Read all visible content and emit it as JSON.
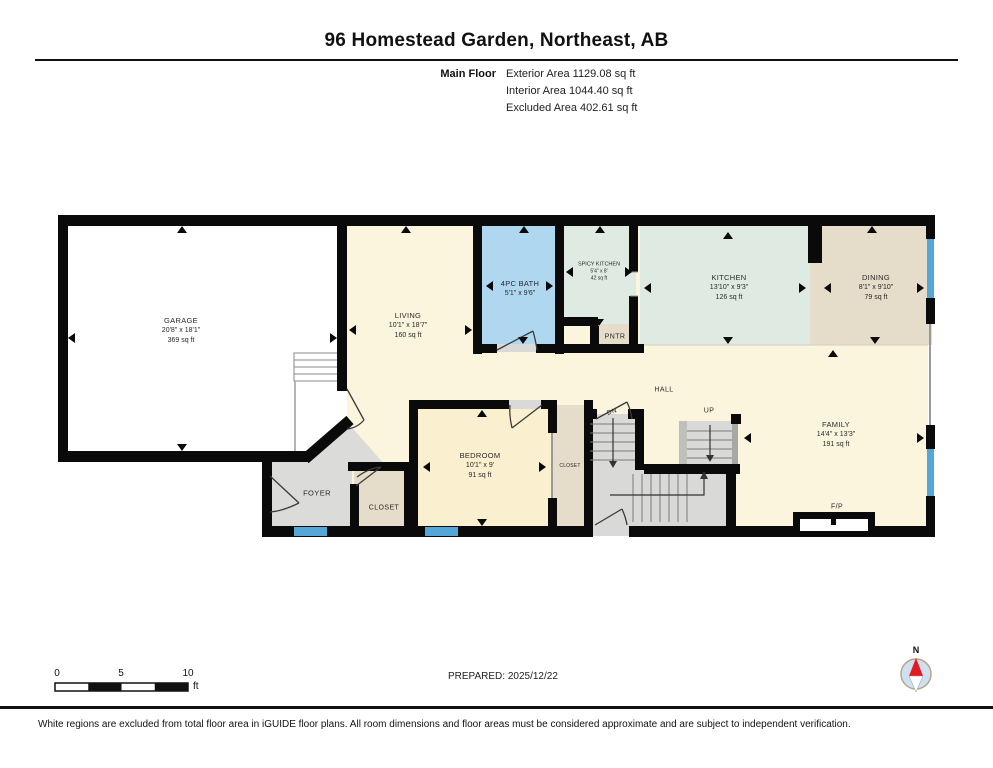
{
  "header": {
    "title": "96 Homestead Garden, Northeast, AB",
    "floor_label": "Main Floor",
    "area_lines": [
      "Exterior Area 1129.08 sq ft",
      "Interior Area 1044.40 sq ft",
      "Excluded Area 402.61 sq ft"
    ]
  },
  "rooms": [
    {
      "name": "GARAGE",
      "dims": "20'8\" x 18'1\"",
      "area": "369 sq ft"
    },
    {
      "name": "LIVING",
      "dims": "10'1\" x 18'7\"",
      "area": "160 sq ft"
    },
    {
      "name": "4PC BATH",
      "dims": "5'1\" x 9'6\"",
      "area": ""
    },
    {
      "name": "SPICY KITCHEN",
      "dims": "5'4\" x 8'",
      "area": "42 sq ft"
    },
    {
      "name": "KITCHEN",
      "dims": "13'10\" x 9'3\"",
      "area": "126 sq ft"
    },
    {
      "name": "DINING",
      "dims": "8'1\" x 9'10\"",
      "area": "79 sq ft"
    },
    {
      "name": "BEDROOM",
      "dims": "10'1\" x 9'",
      "area": "91 sq ft"
    },
    {
      "name": "FAMILY",
      "dims": "14'4\" x 13'3\"",
      "area": "191 sq ft"
    }
  ],
  "labels": {
    "hall": "HALL",
    "dn": "DN",
    "up": "UP",
    "pntr": "PNTR",
    "foyer": "FOYER",
    "closet_entry": "CLOSET",
    "closet_bedroom": "CLOSET",
    "fireplace": "F/P"
  },
  "scale_bar": {
    "tick_0": "0",
    "tick_5": "5",
    "tick_10": "10",
    "unit": "ft"
  },
  "prepared_label": "PREPARED: 2025/12/22",
  "compass": {
    "north_label": "N"
  },
  "footer": {
    "disclaimer": "White regions are excluded from total floor area in iGUIDE floor plans. All room dimensions and floor areas must be considered approximate and are subject to independent verification."
  },
  "colors": {
    "floor_cream": "#FBF5DE",
    "bedroom_cream": "#FAEFCE",
    "bath_blue": "#AFD7F0",
    "kitchen_green": "#DFEAE3",
    "tan": "#E5DCC9",
    "gray_floor": "#DBDBD9",
    "window_blue": "#55A7D5",
    "wall_black": "#0A0A0A",
    "compass_red": "#E11B22"
  }
}
